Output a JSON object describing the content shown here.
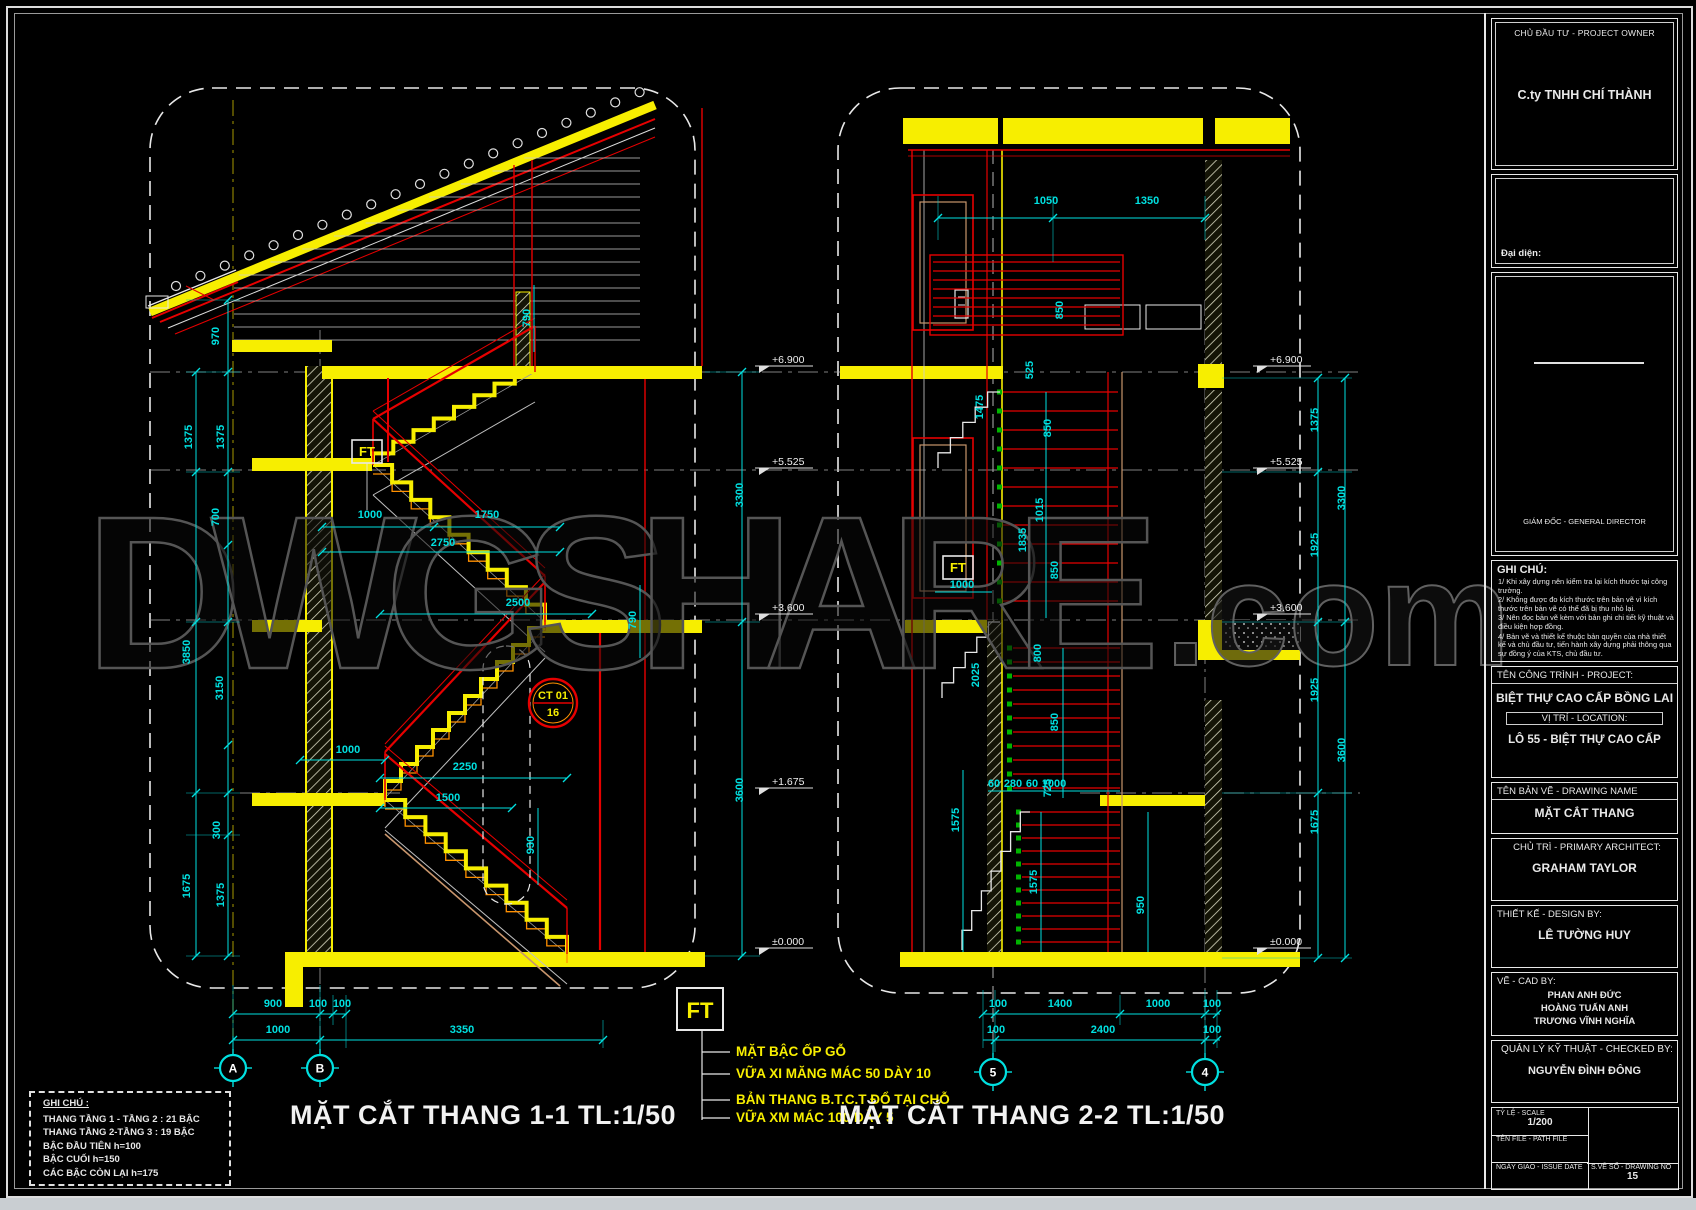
{
  "watermark": {
    "main": "DWGSHARE",
    "suffix": ".com"
  },
  "drawings": {
    "left_title": "MẶT CẮT THANG 1-1 TL:1/50",
    "right_title": "MẶT CẮT THANG 2-2 TL:1/50"
  },
  "notes_box": {
    "title": "GHI CHÚ :",
    "lines": [
      "THANG TẦNG 1 - TẦNG 2 : 21 BẬC",
      "THANG TẦNG 2-TẦNG 3  : 19 BẬC",
      "BẬC ĐẦU TIÊN h=100",
      "BẬC CUỐI h=150",
      "CÁC BẬC CÒN LẠI h=175"
    ]
  },
  "ft_legend": {
    "tag": "FT",
    "items": [
      "MẶT BẬC ỐP GỖ",
      "VỮA XI MĂNG MÁC 50 DÀY 10",
      "BẢN THANG B.T.C.T ĐỔ TẠI CHỖ",
      "VỮA XM MÁC 100 DÀY 5"
    ]
  },
  "callout": {
    "code": "CT 01",
    "number": "16"
  },
  "grid_bubbles": [
    {
      "label": "A",
      "x": 233,
      "y": 1068
    },
    {
      "label": "B",
      "x": 320,
      "y": 1068
    },
    {
      "label": "5",
      "x": 993,
      "y": 1072
    },
    {
      "label": "4",
      "x": 1205,
      "y": 1072
    }
  ],
  "dim_labels_h": [
    {
      "t": "1000",
      "x": 370,
      "y": 518
    },
    {
      "t": "1750",
      "x": 487,
      "y": 518
    },
    {
      "t": "2750",
      "x": 443,
      "y": 546
    },
    {
      "t": "2500",
      "x": 518,
      "y": 606
    },
    {
      "t": "1000",
      "x": 348,
      "y": 753
    },
    {
      "t": "2250",
      "x": 465,
      "y": 770
    },
    {
      "t": "1500",
      "x": 448,
      "y": 801
    },
    {
      "t": "900",
      "x": 273,
      "y": 1007
    },
    {
      "t": "100",
      "x": 318,
      "y": 1007
    },
    {
      "t": "100",
      "x": 342,
      "y": 1007
    },
    {
      "t": "1000",
      "x": 278,
      "y": 1033
    },
    {
      "t": "3350",
      "x": 462,
      "y": 1033
    },
    {
      "t": "1050",
      "x": 1046,
      "y": 204
    },
    {
      "t": "1350",
      "x": 1147,
      "y": 204
    },
    {
      "t": "1000",
      "x": 962,
      "y": 588
    },
    {
      "t": "60",
      "x": 994,
      "y": 787
    },
    {
      "t": "280",
      "x": 1013,
      "y": 787
    },
    {
      "t": "60",
      "x": 1032,
      "y": 787
    },
    {
      "t": "1000",
      "x": 1054,
      "y": 787
    },
    {
      "t": "100",
      "x": 998,
      "y": 1007
    },
    {
      "t": "1400",
      "x": 1060,
      "y": 1007
    },
    {
      "t": "1000",
      "x": 1158,
      "y": 1007
    },
    {
      "t": "100",
      "x": 1212,
      "y": 1007
    },
    {
      "t": "100",
      "x": 996,
      "y": 1033
    },
    {
      "t": "2400",
      "x": 1103,
      "y": 1033
    },
    {
      "t": "100",
      "x": 1212,
      "y": 1033
    }
  ],
  "dim_labels_v": [
    {
      "t": "970",
      "x": 219,
      "y": 336
    },
    {
      "t": "1375",
      "x": 192,
      "y": 437
    },
    {
      "t": "1375",
      "x": 224,
      "y": 437
    },
    {
      "t": "700",
      "x": 219,
      "y": 517
    },
    {
      "t": "3850",
      "x": 190,
      "y": 652
    },
    {
      "t": "3150",
      "x": 223,
      "y": 688
    },
    {
      "t": "300",
      "x": 220,
      "y": 830
    },
    {
      "t": "1675",
      "x": 190,
      "y": 886
    },
    {
      "t": "1375",
      "x": 224,
      "y": 895
    },
    {
      "t": "790",
      "x": 530,
      "y": 318
    },
    {
      "t": "790",
      "x": 636,
      "y": 620
    },
    {
      "t": "930",
      "x": 534,
      "y": 845
    },
    {
      "t": "3300",
      "x": 743,
      "y": 495
    },
    {
      "t": "3600",
      "x": 743,
      "y": 790
    },
    {
      "t": "850",
      "x": 1063,
      "y": 310
    },
    {
      "t": "525",
      "x": 1033,
      "y": 370
    },
    {
      "t": "1475",
      "x": 983,
      "y": 407
    },
    {
      "t": "850",
      "x": 1051,
      "y": 428
    },
    {
      "t": "1015",
      "x": 1043,
      "y": 510
    },
    {
      "t": "1835",
      "x": 1026,
      "y": 540
    },
    {
      "t": "850",
      "x": 1058,
      "y": 570
    },
    {
      "t": "800",
      "x": 1041,
      "y": 653
    },
    {
      "t": "2025",
      "x": 979,
      "y": 675
    },
    {
      "t": "850",
      "x": 1058,
      "y": 722
    },
    {
      "t": "725",
      "x": 1051,
      "y": 788
    },
    {
      "t": "1575",
      "x": 959,
      "y": 820
    },
    {
      "t": "1575",
      "x": 1037,
      "y": 882
    },
    {
      "t": "950",
      "x": 1144,
      "y": 905
    },
    {
      "t": "1375",
      "x": 1318,
      "y": 420
    },
    {
      "t": "3300",
      "x": 1345,
      "y": 498
    },
    {
      "t": "1925",
      "x": 1318,
      "y": 545
    },
    {
      "t": "1925",
      "x": 1318,
      "y": 690
    },
    {
      "t": "3600",
      "x": 1345,
      "y": 750
    },
    {
      "t": "1675",
      "x": 1318,
      "y": 822
    }
  ],
  "level_marks": [
    {
      "t": "+6.900",
      "x": 755,
      "y": 366
    },
    {
      "t": "+5.525",
      "x": 755,
      "y": 468
    },
    {
      "t": "+3.600",
      "x": 755,
      "y": 614
    },
    {
      "t": "+1.675",
      "x": 755,
      "y": 788
    },
    {
      "t": "±0.000",
      "x": 755,
      "y": 948
    },
    {
      "t": "+6.900",
      "x": 1253,
      "y": 366
    },
    {
      "t": "+5.525",
      "x": 1253,
      "y": 468
    },
    {
      "t": "+3.600",
      "x": 1253,
      "y": 614
    },
    {
      "t": "±0.000",
      "x": 1253,
      "y": 948
    }
  ],
  "title_block": {
    "owner_label": "CHỦ ĐẦU TƯ - PROJECT OWNER",
    "owner_name": "C.ty TNHH CHÍ THÀNH",
    "representative_label": "Đại diện:",
    "director_label": "GIÁM ĐỐC - GENERAL DIRECTOR",
    "notes_title": "GHI CHÚ:",
    "notes": [
      "1/ Khi xây dựng nên kiểm tra lại kích thước tại công trường.",
      "2/ Không được đo kích thước trên bản vẽ vì kích thước trên bản vẽ có thể đã bị thu nhỏ lại.",
      "3/ Nên đọc bản vẽ kèm với bản ghi chi tiết kỹ thuật và điều kiện hợp đồng.",
      "4/ Bản vẽ và thiết kế thuộc bản quyền của nhà thiết kế và chủ đầu tư, tiến hành xây dựng phải thông qua sự đồng ý của KTS, chủ đầu tư."
    ],
    "project_label": "TÊN CÔNG TRÌNH - PROJECT:",
    "project_name": "BIỆT THỰ CAO CẤP BỒNG LAI",
    "location_label": "VỊ TRÍ - LOCATION:",
    "location_name": "LÔ 55 - BIỆT THỰ CAO CẤP",
    "drawing_label": "TÊN BẢN VẼ - DRAWING NAME",
    "drawing_name": "MẶT CẮT THANG",
    "architect_label": "CHỦ TRÌ - PRIMARY ARCHITECT:",
    "architect_name": "GRAHAM TAYLOR",
    "design_label": "THIẾT KẾ - DESIGN BY:",
    "design_name": "LÊ TƯỜNG HUY",
    "cad_label": "VẼ - CAD BY:",
    "cad_names": [
      "PHAN ANH ĐỨC",
      "HOÀNG TUẤN ANH",
      "TRƯƠNG VĨNH NGHĨA"
    ],
    "checked_label": "QUẢN LÝ KỸ THUẬT - CHECKED BY:",
    "checked_name": "NGUYỄN ĐÌNH ĐÔNG",
    "scale_label": "TỶ LỆ - SCALE",
    "scale_value": "1/200",
    "file_label": "TÊN FILE - PATH FILE",
    "date_label": "NGÀY GIAO - ISSUE DATE",
    "number_label": "S.VẼ SỐ - DRAWING NO",
    "number_value": "15"
  },
  "colors": {
    "dim_cyan": "#00e0e0",
    "cad_yellow": "#f7ee00",
    "cad_red": "#e60000",
    "cad_orange": "#ff9000",
    "cad_green": "#00b400"
  }
}
